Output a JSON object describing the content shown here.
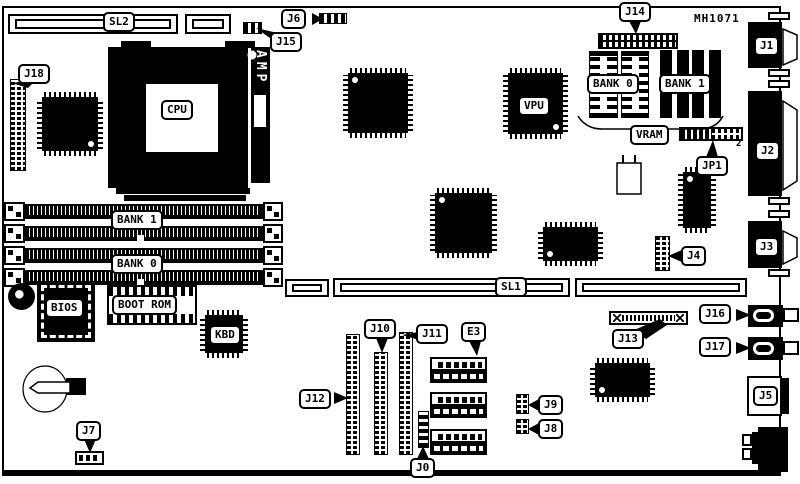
{
  "part_number": "MH1071",
  "labels": {
    "sl1": "SL1",
    "sl2": "SL2",
    "j0": "J0",
    "j1": "J1",
    "j2": "J2",
    "j3": "J3",
    "j4": "J4",
    "j5": "J5",
    "j6": "J6",
    "j7": "J7",
    "j8": "J8",
    "j9": "J9",
    "j10": "J10",
    "j11": "J11",
    "j12": "J12",
    "j13": "J13",
    "j14": "J14",
    "j15": "J15",
    "j16": "J16",
    "j17": "J17",
    "j18": "J18",
    "jp1": "JP1",
    "jp1_pin2": "2",
    "cpu": "CPU",
    "vpu": "VPU",
    "amp": "AMP",
    "kbd": "KBD",
    "bios": "BIOS",
    "boot_rom": "BOOT ROM",
    "vram": "VRAM",
    "e3": "E3",
    "bank0": "BANK 0",
    "bank1": "BANK 1"
  }
}
